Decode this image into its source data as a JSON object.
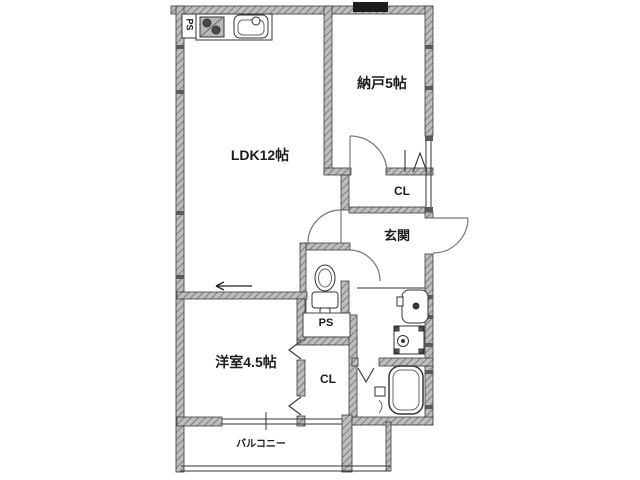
{
  "floorplan": {
    "rooms": {
      "ldk": "LDK12帖",
      "storage": "納戸5帖",
      "closet_upper": "CL",
      "entrance": "玄関",
      "pipe_space_toilet": "PS",
      "western_room": "洋室4.5帖",
      "closet_lower": "CL",
      "balcony": "バルコニー",
      "pipe_space_kitchen": "PS"
    },
    "icons": [
      "kitchen-sink-icon",
      "stove-icon",
      "toilet-icon",
      "washbasin-icon",
      "washing-machine-icon",
      "bathtub-icon",
      "door-swing-arc",
      "sliding-door-arrow",
      "bifold-door-mark",
      "window-mark"
    ],
    "colors": {
      "background": "#ffffff",
      "wall_fill": "#bdbdbd",
      "wall_stripe": "#7e7e7e",
      "wall_outline": "#3d3d3d",
      "line": "#333333",
      "door_arc": "#777777",
      "window_dark": "#1b1b1b",
      "text": "#1c1c1c"
    }
  }
}
